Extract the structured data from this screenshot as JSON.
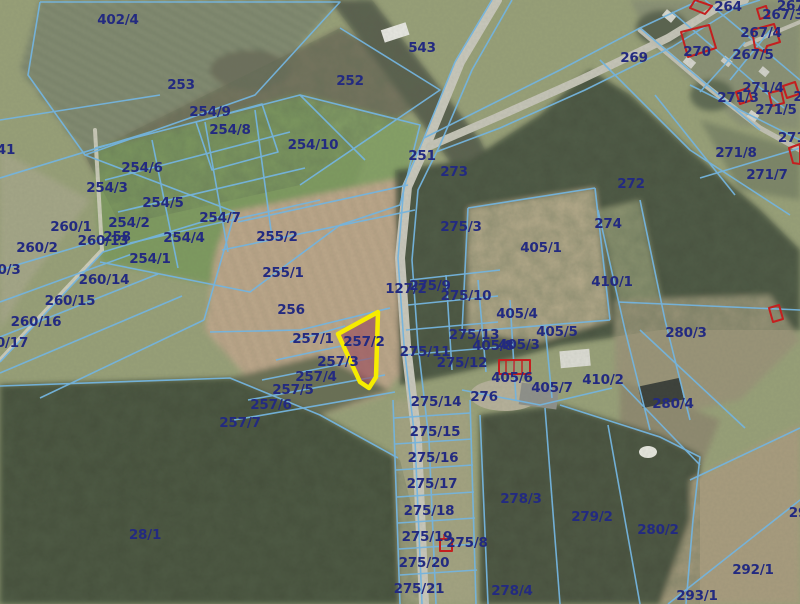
{
  "app": {
    "type": "cadastral-map-viewer",
    "view": "aerial-orthophoto-with-parcels"
  },
  "map": {
    "highlighted_parcel": {
      "id": "257/2",
      "outline_color": "#f6ec00",
      "fill_color": "rgba(151,72,90,0.60)"
    },
    "colors": {
      "parcel_line": "#74b4de",
      "label_text": "#232a80",
      "building_outline": "#c41f1f",
      "road": "#c9c8bc"
    },
    "labels": [
      {
        "text": "402/4",
        "x": 118,
        "y": 20
      },
      {
        "text": "253",
        "x": 181,
        "y": 85
      },
      {
        "text": "254/9",
        "x": 210,
        "y": 112
      },
      {
        "text": "254/8",
        "x": 230,
        "y": 130
      },
      {
        "text": "254/10",
        "x": 313,
        "y": 145
      },
      {
        "text": "252",
        "x": 350,
        "y": 81
      },
      {
        "text": "543",
        "x": 422,
        "y": 48
      },
      {
        "text": "264",
        "x": 728,
        "y": 7
      },
      {
        "text": "267/",
        "x": 793,
        "y": 6
      },
      {
        "text": "267/3",
        "x": 783,
        "y": 15
      },
      {
        "text": "267/4",
        "x": 761,
        "y": 33
      },
      {
        "text": "270",
        "x": 697,
        "y": 52
      },
      {
        "text": "267/5",
        "x": 753,
        "y": 55
      },
      {
        "text": "269",
        "x": 634,
        "y": 58
      },
      {
        "text": "251",
        "x": 422,
        "y": 156
      },
      {
        "text": "273",
        "x": 454,
        "y": 172
      },
      {
        "text": "271/4",
        "x": 763,
        "y": 88
      },
      {
        "text": "271/3",
        "x": 738,
        "y": 98
      },
      {
        "text": "2",
        "x": 798,
        "y": 97
      },
      {
        "text": "271/5",
        "x": 776,
        "y": 110
      },
      {
        "text": "271/",
        "x": 794,
        "y": 138
      },
      {
        "text": "271/8",
        "x": 736,
        "y": 153
      },
      {
        "text": "271/7",
        "x": 767,
        "y": 175
      },
      {
        "text": "272",
        "x": 631,
        "y": 184
      },
      {
        "text": "274",
        "x": 608,
        "y": 224
      },
      {
        "text": "275/3",
        "x": 461,
        "y": 227
      },
      {
        "text": "405/1",
        "x": 541,
        "y": 248
      },
      {
        "text": "410/1",
        "x": 612,
        "y": 282
      },
      {
        "text": "41",
        "x": 6,
        "y": 150
      },
      {
        "text": "260/1",
        "x": 71,
        "y": 227
      },
      {
        "text": "254/3",
        "x": 107,
        "y": 188
      },
      {
        "text": "254/6",
        "x": 142,
        "y": 168
      },
      {
        "text": "254/5",
        "x": 163,
        "y": 203
      },
      {
        "text": "254/2",
        "x": 129,
        "y": 223
      },
      {
        "text": "254/7",
        "x": 220,
        "y": 218
      },
      {
        "text": "254/4",
        "x": 184,
        "y": 238
      },
      {
        "text": "254/1",
        "x": 150,
        "y": 259
      },
      {
        "text": "260/2",
        "x": 37,
        "y": 248
      },
      {
        "text": "260/13",
        "x": 103,
        "y": 241
      },
      {
        "text": "258",
        "x": 117,
        "y": 237
      },
      {
        "text": "0/3",
        "x": 9,
        "y": 270
      },
      {
        "text": "260/14",
        "x": 104,
        "y": 280
      },
      {
        "text": "260/15",
        "x": 70,
        "y": 301
      },
      {
        "text": "260/16",
        "x": 36,
        "y": 322
      },
      {
        "text": "0/17",
        "x": 12,
        "y": 343
      },
      {
        "text": "255/2",
        "x": 277,
        "y": 237
      },
      {
        "text": "255/1",
        "x": 283,
        "y": 273
      },
      {
        "text": "256",
        "x": 291,
        "y": 310
      },
      {
        "text": "257/1",
        "x": 313,
        "y": 339
      },
      {
        "text": "257/2",
        "x": 364,
        "y": 342
      },
      {
        "text": "127/2",
        "x": 406,
        "y": 289
      },
      {
        "text": "275/9",
        "x": 430,
        "y": 286
      },
      {
        "text": "275/10",
        "x": 466,
        "y": 296
      },
      {
        "text": "257/3",
        "x": 338,
        "y": 362
      },
      {
        "text": "257/4",
        "x": 316,
        "y": 377
      },
      {
        "text": "257/5",
        "x": 293,
        "y": 390
      },
      {
        "text": "257/6",
        "x": 271,
        "y": 405
      },
      {
        "text": "257/7",
        "x": 240,
        "y": 423
      },
      {
        "text": "275/13",
        "x": 474,
        "y": 335
      },
      {
        "text": "405/8",
        "x": 493,
        "y": 346
      },
      {
        "text": "405/3",
        "x": 519,
        "y": 345
      },
      {
        "text": "405/4",
        "x": 517,
        "y": 314
      },
      {
        "text": "405/5",
        "x": 557,
        "y": 332
      },
      {
        "text": "275/11",
        "x": 425,
        "y": 352
      },
      {
        "text": "275/12",
        "x": 462,
        "y": 363
      },
      {
        "text": "405/6",
        "x": 512,
        "y": 378
      },
      {
        "text": "405/7",
        "x": 552,
        "y": 388
      },
      {
        "text": "410/2",
        "x": 603,
        "y": 380
      },
      {
        "text": "276",
        "x": 484,
        "y": 397
      },
      {
        "text": "280/3",
        "x": 686,
        "y": 333
      },
      {
        "text": "280/4",
        "x": 673,
        "y": 404
      },
      {
        "text": "275/14",
        "x": 436,
        "y": 402
      },
      {
        "text": "275/15",
        "x": 435,
        "y": 432
      },
      {
        "text": "275/16",
        "x": 433,
        "y": 458
      },
      {
        "text": "275/17",
        "x": 432,
        "y": 484
      },
      {
        "text": "275/18",
        "x": 429,
        "y": 511
      },
      {
        "text": "275/19",
        "x": 427,
        "y": 537
      },
      {
        "text": "275/8",
        "x": 467,
        "y": 543
      },
      {
        "text": "275/20",
        "x": 424,
        "y": 563
      },
      {
        "text": "275/21",
        "x": 419,
        "y": 589
      },
      {
        "text": "278/3",
        "x": 521,
        "y": 499
      },
      {
        "text": "278/4",
        "x": 512,
        "y": 591
      },
      {
        "text": "279/2",
        "x": 592,
        "y": 517
      },
      {
        "text": "280/2",
        "x": 658,
        "y": 530
      },
      {
        "text": "292/1",
        "x": 753,
        "y": 570
      },
      {
        "text": "293/1",
        "x": 697,
        "y": 596
      },
      {
        "text": "29",
        "x": 798,
        "y": 513
      },
      {
        "text": "28/1",
        "x": 145,
        "y": 535
      }
    ]
  }
}
